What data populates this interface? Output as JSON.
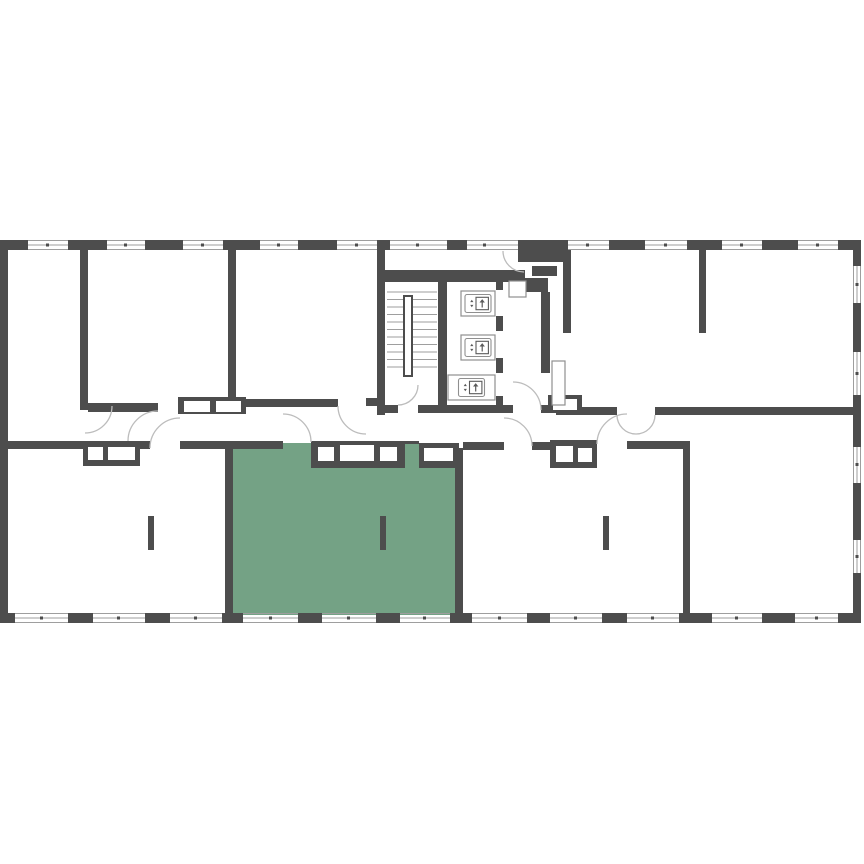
{
  "colors": {
    "background": "#ffffff",
    "wall": "#4d4d4d",
    "line": "#9e9e9e",
    "arc": "#bcbcbc",
    "icon": "#8f8f8f",
    "icon_dark": "#5a5a5a",
    "highlight": "#74a285"
  },
  "plan": {
    "kind": "residential-floor-plan",
    "visible_text": [],
    "highlighted_unit": {
      "present": true,
      "shape": "room",
      "fill": "#74a285"
    },
    "elevators": {
      "count": 3,
      "icon": "elevator-up-icon"
    },
    "stairwell": {
      "present": true,
      "flights": 2
    },
    "radiators": {
      "count": 3
    },
    "door_swings": {
      "count": 10
    },
    "window_strips": {
      "top": true,
      "bottom": true,
      "right": true
    }
  }
}
